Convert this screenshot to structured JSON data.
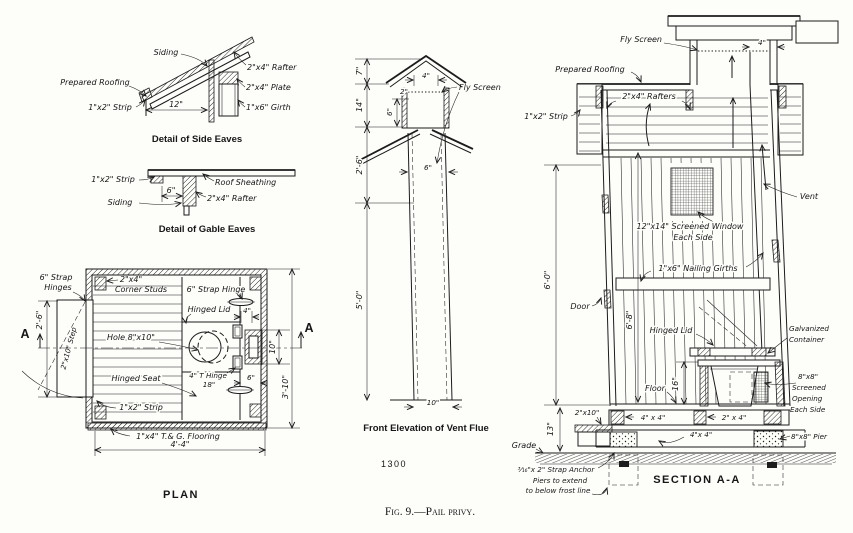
{
  "colors": {
    "ink": "#1c1c1c",
    "paper": "#fdfdfa"
  },
  "figure": {
    "caption": "Fig. 9.—Pail privy.",
    "plate_number": "1300"
  },
  "side_eaves": {
    "title": "Detail of Side Eaves",
    "labels": {
      "siding": "Siding",
      "prepared_roofing": "Prepared Roofing",
      "strip": "1\"x2\" Strip",
      "dim_12": "12\"",
      "rafter": "2\"x4\" Rafter",
      "plate": "2\"x4\" Plate",
      "girth": "1\"x6\" Girth"
    }
  },
  "gable_eaves": {
    "title": "Detail of Gable Eaves",
    "labels": {
      "strip": "1\"x2\" Strip",
      "siding": "Siding",
      "dim_6": "6\"",
      "roof_sheathing": "Roof Sheathing",
      "rafter": "2\"x4\" Rafter"
    }
  },
  "plan": {
    "title": "PLAN",
    "section_marker": "A",
    "labels": {
      "strap_hinges_1": "6\" Strap",
      "strap_hinges_2": "Hinges",
      "corner_studs_1": "2\"x4\"",
      "corner_studs_2": "Corner Studs",
      "strap_hinge": "6\" Strap Hinge",
      "hinged_lid": "Hinged Lid",
      "hole": "Hole 8\"x10\"",
      "hinged_seat": "Hinged Seat",
      "t_hinge": "4\" T Hinge",
      "dim_18": "18\"",
      "dim_6": "6\"",
      "dim_4": "4\"",
      "dim_10": "10\"",
      "dim_2_6": "2'-6\"",
      "dim_3_10": "3'-10\"",
      "dim_4_4": "4'-4\"",
      "step": "2\"x10\" Step",
      "strip": "1\"x2\" Strip",
      "flooring": "1\"x4\" T.& G. Flooring"
    }
  },
  "vent_flue": {
    "title": "Front Elevation of Vent Flue",
    "labels": {
      "fly_screen": "Fly Screen",
      "dim_7": "7\"",
      "dim_14": "14\"",
      "dim_2_6": "2'-6\"",
      "dim_5_0": "5'-0\"",
      "dim_4": "4\"",
      "dim_2": "2\"",
      "dim_6_top": "6\"",
      "dim_6_mid": "6\"",
      "dim_10": "10\""
    }
  },
  "section": {
    "title": "SECTION A-A",
    "labels": {
      "fly_screen": "Fly Screen",
      "dim_4": "4\"",
      "prepared_roofing": "Prepared Roofing",
      "rafters": "2\"x4\" Rafters",
      "strip": "1\"x2\" Strip",
      "vent": "Vent",
      "window_1": "12\"x14\" Screened Window",
      "window_2": "Each Side",
      "girths": "1\"x6\" Nailing Girths",
      "dim_6_0": "6'-0\"",
      "door": "Door",
      "dim_6_8": "6'-8\"",
      "hinged_lid": "Hinged Lid",
      "galvanized_1": "Galvanized",
      "galvanized_2": "Container",
      "dim_16": "16\"",
      "floor": "Floor",
      "opening_1": "8\"x8\"",
      "opening_2": "Screened",
      "opening_3": "Opening",
      "opening_4": "Each Side",
      "dim_2x10": "2\"x10\"",
      "dim_4x4_joist": "4\" x 4\"",
      "dim_2x4": "2\" x 4\"",
      "sill_4x4": "4\"x 4\"",
      "dim_13": "13\"",
      "grade": "Grade",
      "pier": "8\"x8\" Pier",
      "strap_anchor": "³⁄₁₆\"x 2\" Strap Anchor",
      "piers_note_1": "Piers to extend",
      "piers_note_2": "to below frost line"
    }
  }
}
